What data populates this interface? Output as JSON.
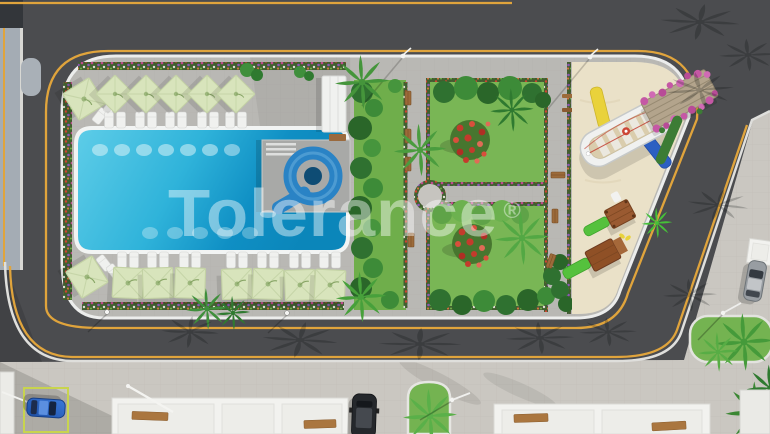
{
  "watermark": {
    "text": "Tolerance",
    "registered": "®"
  },
  "palette": {
    "asphalt": "#4b4c4f",
    "service_road": "#a4acb4",
    "lane_yellow": "#e0a43c",
    "sidewalk": "#cac7c1",
    "deck": "#b9b8b4",
    "pool_light": "#5ecde8",
    "pool_dark": "#0b86ba",
    "grass": "#79b655",
    "sand": "#eae1c8",
    "umbrella_green": "#d8e4bc",
    "flower_red": "#c43b2c",
    "bougainvillea_pink": "#c558a5",
    "wood_brown": "#9a5a31",
    "slide_blue": "#2a83c5",
    "car_blue": "#2b6fd4",
    "playground_green": "#55c13d"
  },
  "scene": {
    "type": "aerial 3D render of residential complex amenities",
    "objects": [
      "perimeter roads with yellow edge lines",
      "swimming pool with spiral water slide",
      "sun umbrellas and loungers",
      "two garden squares with red flower bushes",
      "children playground with boat play structure",
      "pergola with pink bougainvillea",
      "parked cars",
      "building rooftops",
      "palm trees and green islands"
    ]
  }
}
